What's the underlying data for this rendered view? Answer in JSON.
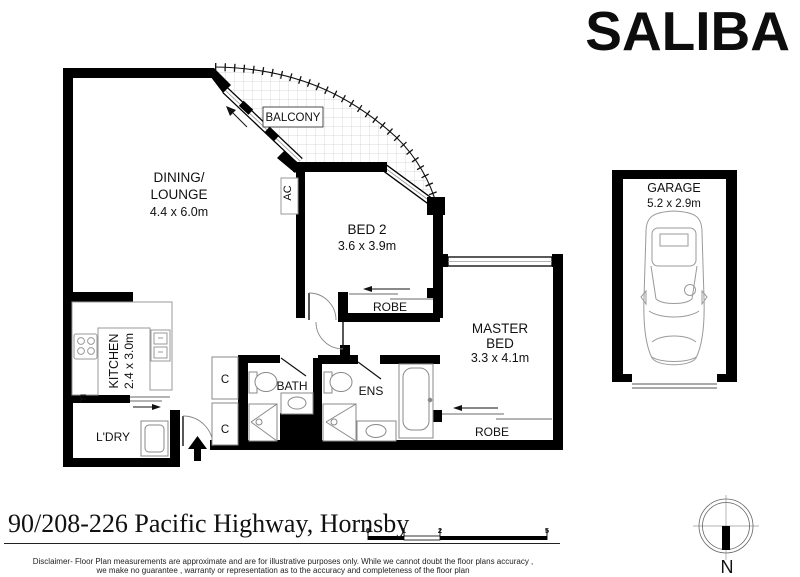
{
  "logo": {
    "text": "SALIBA"
  },
  "rooms": {
    "balcony": "BALCONY",
    "dining1": "DINING/",
    "dining2": "LOUNGE",
    "dining_dims": "4.4 x 6.0m",
    "ac": "AC",
    "bed2": "BED 2",
    "bed2_dims": "3.6 x 3.9m",
    "robe_bed2": "ROBE",
    "master1": "MASTER",
    "master2": "BED",
    "master_dims": "3.3 x 4.1m",
    "robe_master": "ROBE",
    "kitchen": "KITCHEN",
    "kitchen_dims": "2.4 x 3.0m",
    "fridge": "F",
    "laundry": "L'DRY",
    "closet_top": "C",
    "closet_bottom": "C",
    "bath": "BATH",
    "ens": "ENS",
    "garage": "GARAGE",
    "garage_dims": "5.2 x 2.9m"
  },
  "footer": {
    "address": "90/208-226 Pacific Highway, Hornsby",
    "disclaimer1": "Disclaimer- Floor Plan measurements are approximate and are for illustrative purposes only. While we cannot doubt the floor plans accuracy ,",
    "disclaimer2": "we make no guarantee , warranty or representation as to the accuracy and completeness of the floor plan",
    "scale_ticks": [
      "0",
      "1",
      "2",
      "5"
    ],
    "north": "N"
  },
  "colors": {
    "wall": "#000000",
    "fixture": "#8a8a8a",
    "tile": "#cccccc"
  }
}
